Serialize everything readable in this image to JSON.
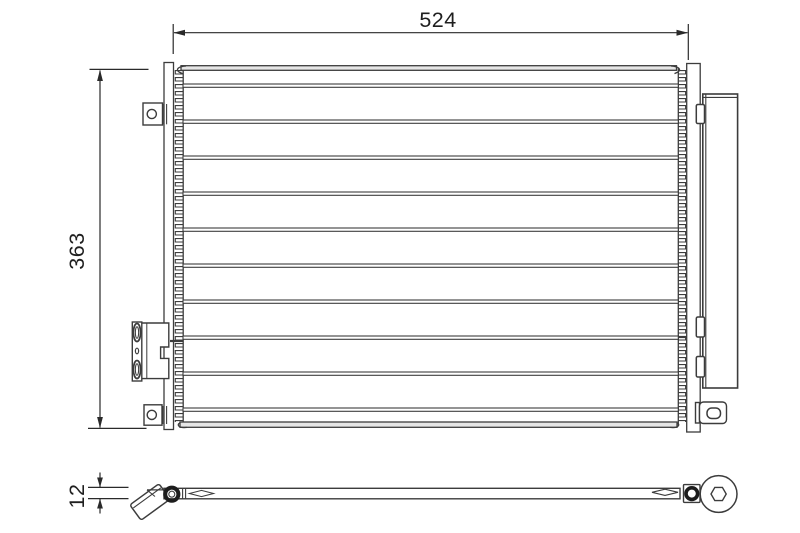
{
  "page": {
    "type": "technical part drawing (condenser, front and side view)",
    "background": "#ffffff"
  },
  "labels": {
    "width": "524",
    "height": "363",
    "thickness": "12"
  },
  "colors": {
    "line": "#3c3c3c",
    "bold_line": "#222222",
    "text": "#1f1f1f",
    "bar_fill": "#e6e6e6"
  }
}
